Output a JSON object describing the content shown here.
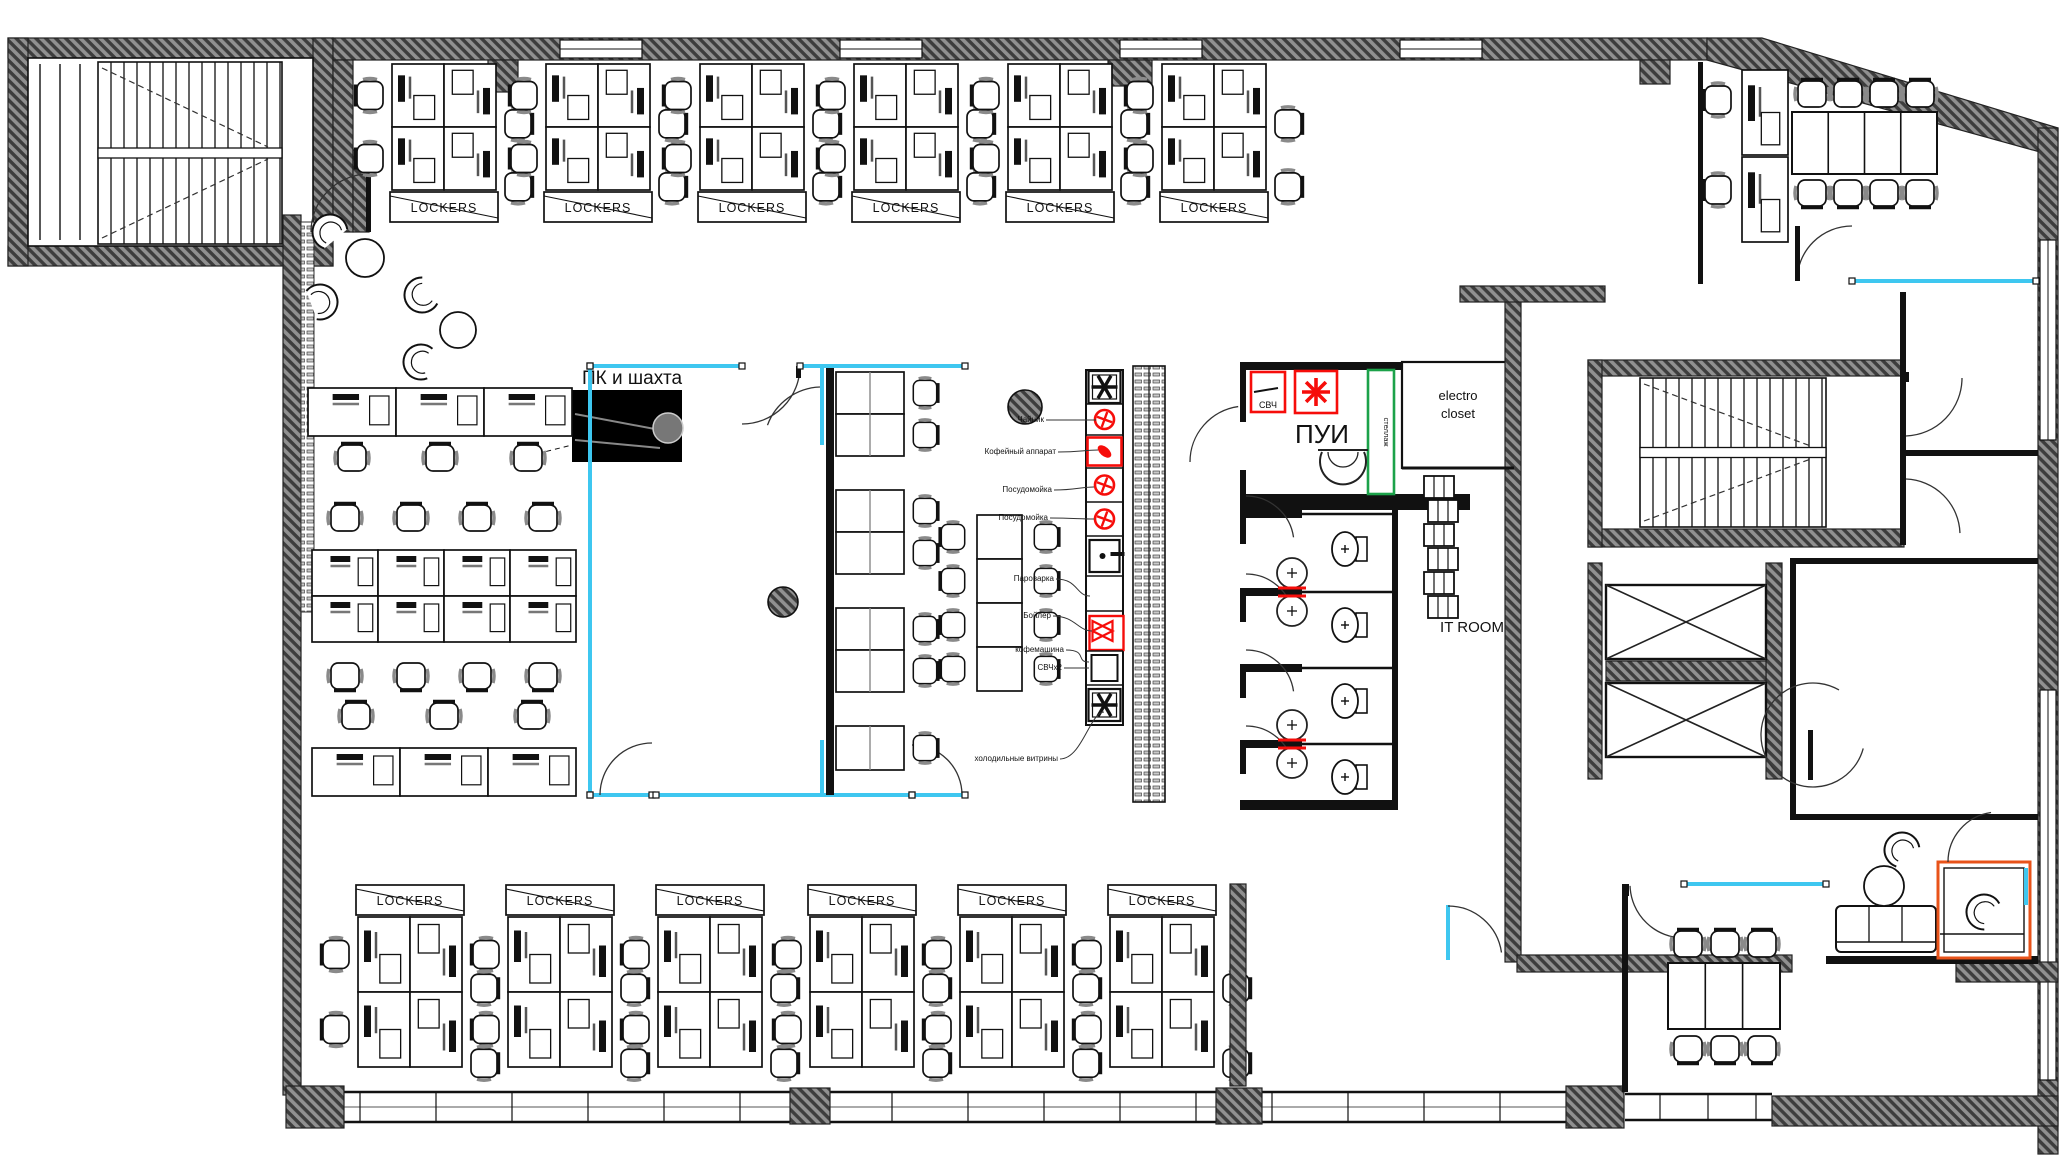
{
  "title": "Office floor plan",
  "colors": {
    "wall_dark": "#3d3d3d",
    "wall_base": "#909090",
    "glass_cyan": "#3ec7f0",
    "appliance_red": "#f60d0a",
    "rack_green": "#1ca24a",
    "booth_orange": "#e8531a",
    "line_black": "#111111"
  },
  "labels": {
    "electro_top": [
      "electro",
      "closet"
    ],
    "pk_shaft": "ПК и шахта",
    "lockers": "LOCKERS",
    "pui": "ПУИ",
    "svch": "СВЧ",
    "electro_right": [
      "electro",
      "closet"
    ],
    "it_room": "IT ROOM",
    "green_rack": "стеллаж"
  },
  "kitchen_labels": [
    "Чайник",
    "Кофейный аппарат",
    "Посудомойка",
    "Посудомойка",
    "Пароварка",
    "Бойлер",
    "кофемашина",
    "СВЧх2",
    "холодильные витрины"
  ],
  "counts": {
    "top_locker_clusters": 6,
    "bottom_locker_clusters": 6,
    "toilet_stalls": 4,
    "elevators": 2,
    "stairwells": 2
  }
}
